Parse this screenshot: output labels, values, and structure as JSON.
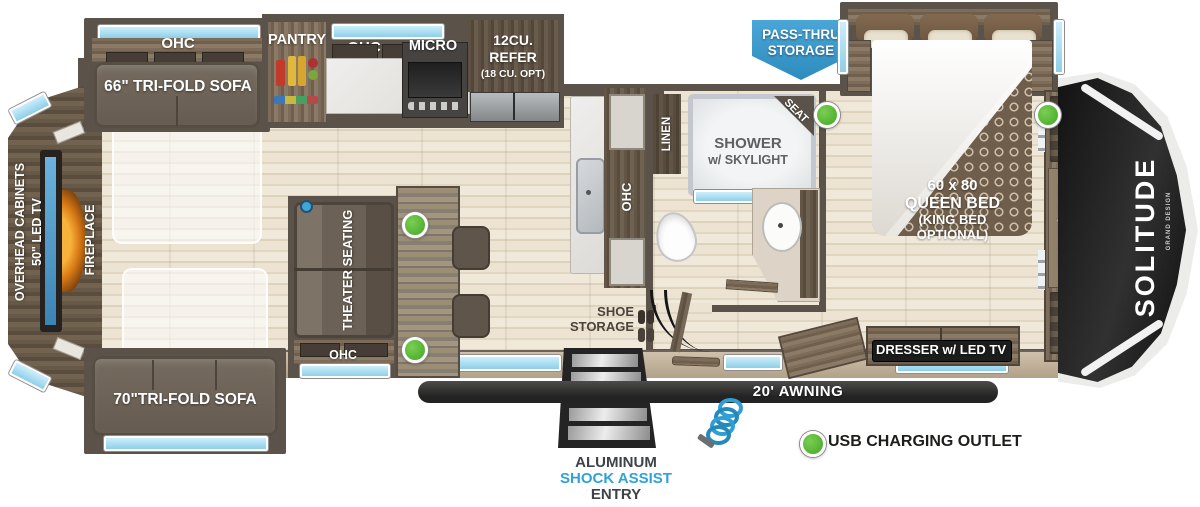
{
  "labels": {
    "ohc": "OHC",
    "sofa66": "66\" TRI-FOLD SOFA",
    "pantry": "PANTRY",
    "micro": "MICRO",
    "refer1": "12CU.",
    "refer2": "REFER",
    "refer3": "(18 CU. OPT)",
    "passthru1": "PASS-THRU",
    "passthru2": "STORAGE",
    "seat": "SEAT",
    "shower1": "SHOWER",
    "shower2": "w/ SKYLIGHT",
    "linen": "LINEN",
    "bed1": "60 x 80",
    "bed2": "QUEEN BED",
    "bed3": "(KING BED",
    "bed4": "OPTIONAL)",
    "washer1": "WASHER/DRYER",
    "washer2": "PREP",
    "brand": "SOLITUDE",
    "brand_sub": "GRAND DESIGN",
    "overhead1": "OVERHEAD CABINETS",
    "overhead2": "50\" LED TV",
    "fireplace": "FIREPLACE",
    "theater": "THEATER SEATING",
    "shoe1": "SHOE",
    "shoe2": "STORAGE",
    "sofa70": "70\"TRI-FOLD SOFA",
    "dresser": "DRESSER w/ LED TV",
    "awning": "20' AWNING",
    "entry1": "ALUMINUM",
    "entry2": "SHOCK ASSIST",
    "entry3": "ENTRY"
  },
  "legend": {
    "usb_label": "USB CHARGING OUTLET",
    "usb_outlet_count": 4
  },
  "colors": {
    "wall": "#5b524a",
    "floor": "#e9e0ce",
    "accent_blue": "#3a9ecf",
    "usb_green": "#53b432",
    "awning_black": "#2c2b2b",
    "window_blue": "#a8dcf0",
    "entry_text_blue": "#2fa3d7"
  }
}
